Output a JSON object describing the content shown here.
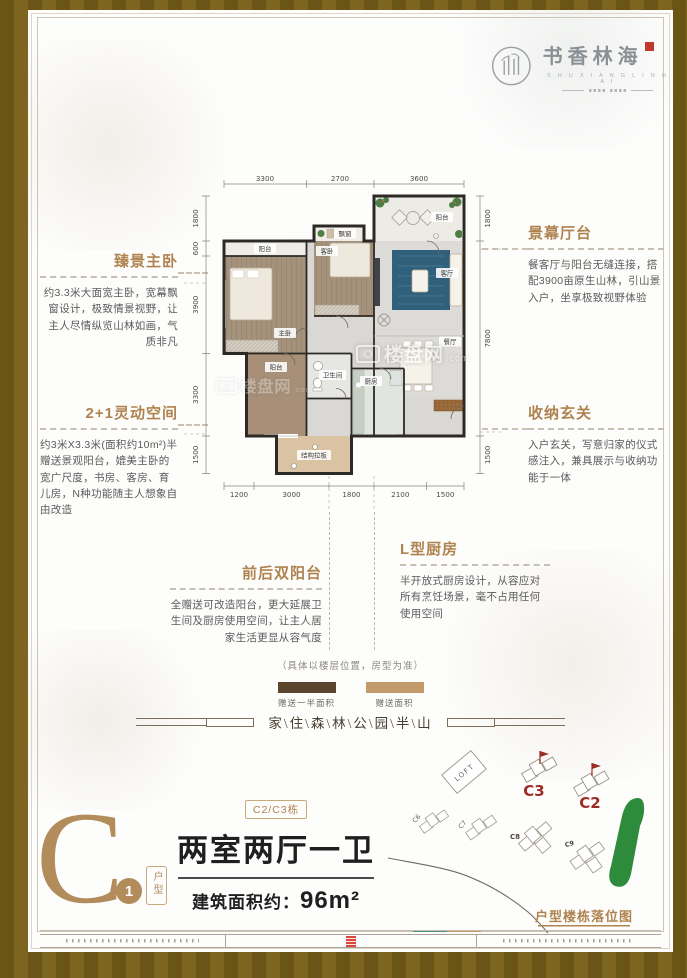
{
  "logo": {
    "name": "书香林海",
    "letters": "S H U X I A N G L I N H A I"
  },
  "callouts": {
    "left1": {
      "title": "臻景主卧",
      "body": "约3.3米大面宽主卧，宽幕飘窗设计，极致情景视野，让主人尽情纵览山林如画，气质非凡"
    },
    "left2": {
      "title": "2+1灵动空间",
      "body": "约3米X3.3米(面积约10m²)半赠送景观阳台，媲美主卧的宽广尺度，书房、客房、育儿房，N种功能随主人想象自由改造"
    },
    "right1": {
      "title": "景幕厅台",
      "body": "餐客厅与阳台无缝连接，搭配3900亩原生山林，引山景入户，坐享极致视野体验"
    },
    "right2": {
      "title": "收纳玄关",
      "body": "入户玄关，写意归家的仪式感注入，兼具展示与收纳功能于一体"
    },
    "bottom1": {
      "title": "前后双阳台",
      "body": "全赠送可改造阳台，更大延展卫生间及厨房使用空间，让主人居家生活更显从容气度"
    },
    "bottom2": {
      "title": "L型厨房",
      "body": "半开放式厨房设计，从容应对所有烹饪场景，毫不占用任何使用空间"
    }
  },
  "floorplan": {
    "dims": {
      "top": [
        "3300",
        "2700",
        "3600"
      ],
      "left": [
        "1800",
        "600",
        "3900",
        "3300",
        "1500"
      ],
      "right": [
        "1800",
        "7800",
        "1500"
      ],
      "bottom": [
        "1200",
        "3000",
        "1800",
        "2100",
        "1500"
      ]
    },
    "rooms": {
      "terrace": "阳台",
      "bay": "飘窗",
      "balcony_top": "阳台",
      "master": "主卧",
      "guest": "客卧",
      "living": "客厅",
      "dining": "餐厅",
      "balcony": "阳台",
      "bath": "卫生间",
      "kitchen": "厨房",
      "slab": "结构拉板"
    }
  },
  "legend": {
    "note": "（具体以楼层位置，房型为准）",
    "items": [
      {
        "label": "赠送一半面积",
        "color": "#5c452f"
      },
      {
        "label": "赠送面积",
        "color": "#c39a6a"
      }
    ]
  },
  "slogan": "家\\住\\森\\林\\公\\园\\半\\山",
  "unit": {
    "letter": "C",
    "number": "1",
    "type_label": "户型",
    "building_badge": "C2/C3栋",
    "title": "两室两厅一卫",
    "area_label": "建筑面积约：",
    "area_value": "96m²"
  },
  "sitemap": {
    "title": "户型楼栋落位图",
    "loft": "LOFT",
    "b_c6": "C6",
    "b_c7": "C7",
    "b_c8": "C8",
    "b_c9": "C9",
    "b_c3": "C3",
    "b_c2": "C2"
  },
  "watermark": {
    "text": "楼盘网",
    "suffix": ".com"
  },
  "colors": {
    "accent": "#af8350",
    "red": "#9e2b25",
    "green": "#2f8b3c",
    "tan": "#c39a6a",
    "dark_brown": "#5c452f"
  }
}
